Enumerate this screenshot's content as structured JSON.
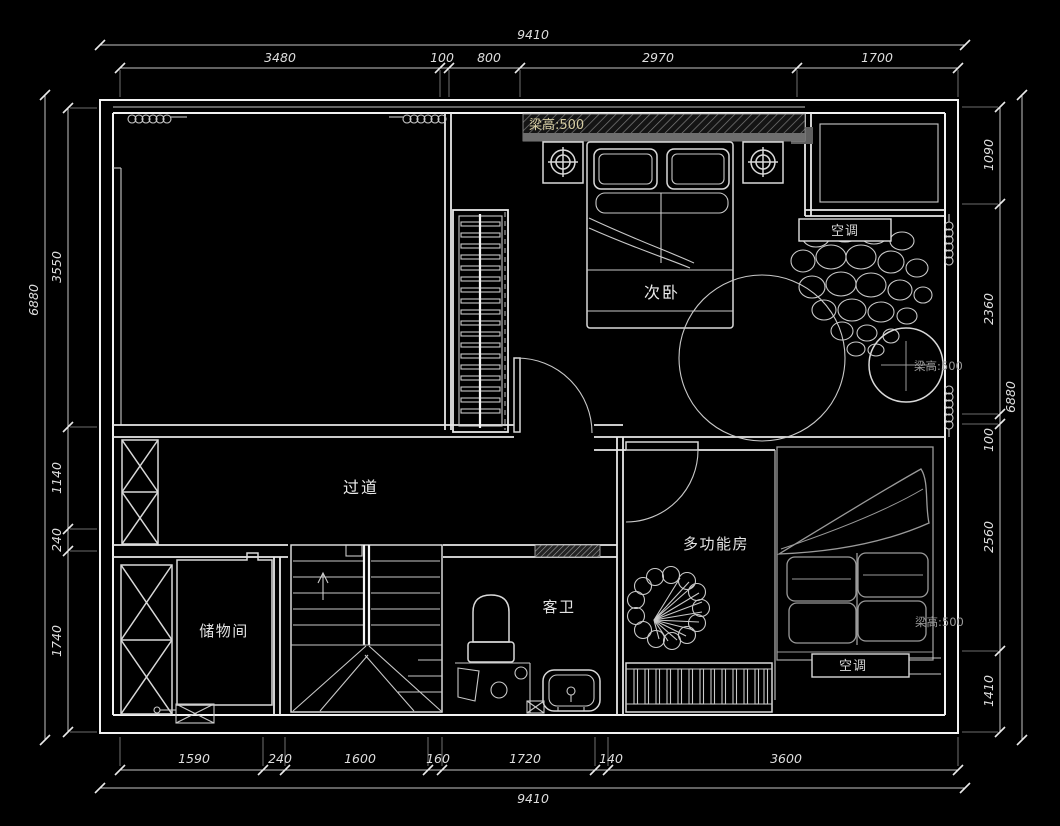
{
  "drawing": {
    "background": "#000000",
    "wall_color": "#f2f2f2",
    "furniture_color": "#d9d9d9",
    "dim_color": "#dedede",
    "beam_note_color": "#d8cfa4",
    "gray_note_color": "#9a9a9a"
  },
  "rooms": {
    "secondary_bedroom": "次卧",
    "corridor": "过道",
    "storage": "储物间",
    "guest_bath": "客卫",
    "multifunction": "多功能房"
  },
  "notes": {
    "beam_top": "梁高:500",
    "beam_mid": "梁高:500",
    "beam_bottom": "梁高:500",
    "ac_top": "空调",
    "ac_bottom": "空调"
  },
  "dims": {
    "top": {
      "total": "9410",
      "segments": [
        "3480",
        "100",
        "800",
        "2970",
        "1700"
      ]
    },
    "bottom": {
      "total": "9410",
      "segments": [
        "1590",
        "240",
        "1600",
        "160",
        "1720",
        "140",
        "3600"
      ]
    },
    "left": {
      "total": "6880",
      "segments": [
        "3550",
        "1140",
        "240",
        "1740"
      ]
    },
    "right": {
      "total": "6880",
      "segments": [
        "1090",
        "2360",
        "100",
        "2560",
        "1410"
      ]
    }
  }
}
